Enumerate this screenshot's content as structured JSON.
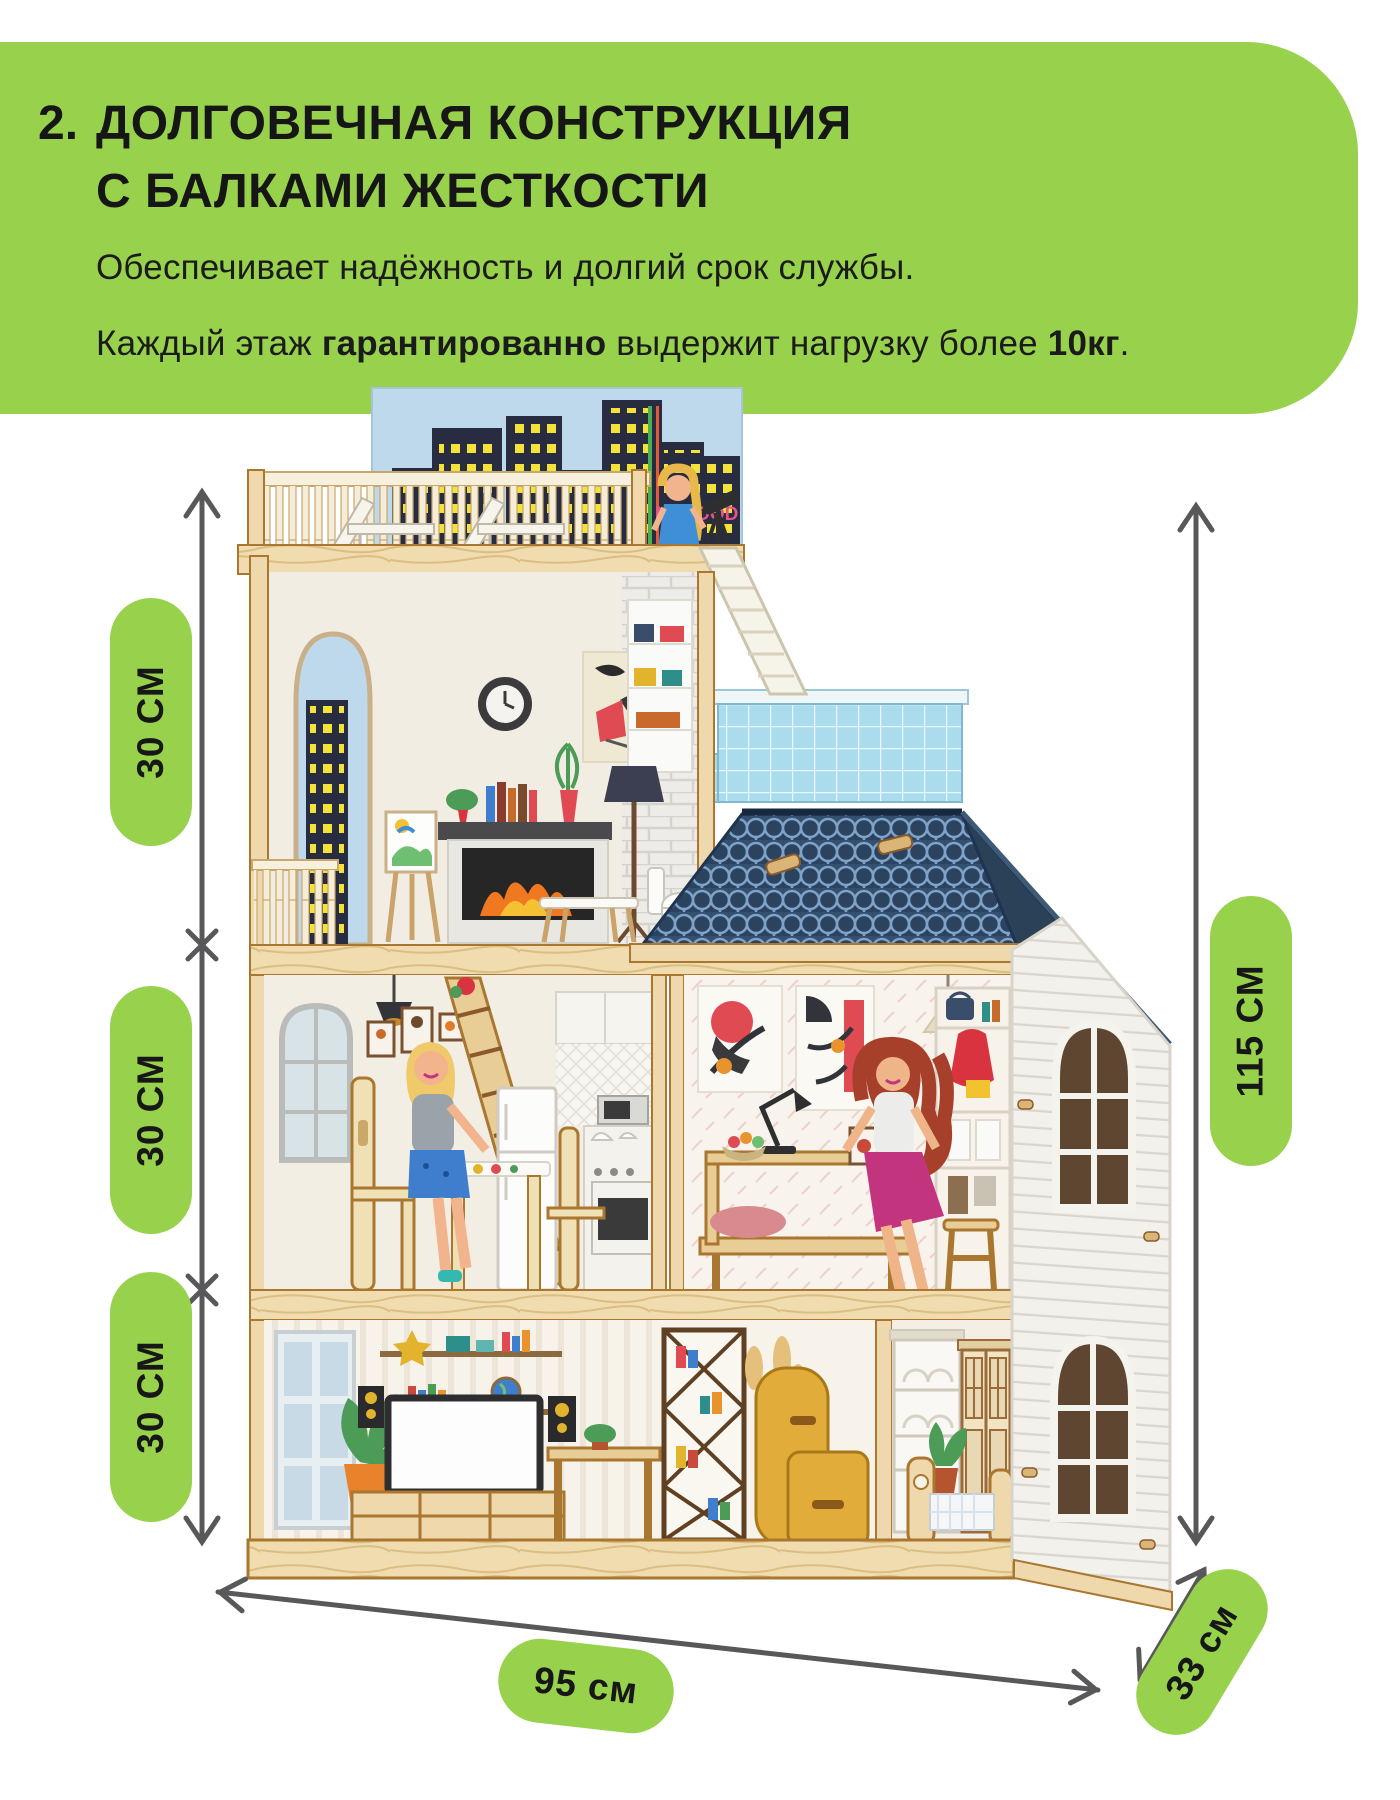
{
  "header": {
    "number": "2.",
    "title_line1": "ДОЛГОВЕЧНАЯ КОНСТРУКЦИЯ",
    "title_line2": "С БАЛКАМИ ЖЕСТКОСТИ",
    "body_line1": "Обеспечивает надёжность и долгий срок службы.",
    "body_line2": {
      "prefix": "Каждый этаж ",
      "bold1": "гарантированно",
      "middle": " выдержит нагрузку более ",
      "bold2": "10кг",
      "suffix": "."
    }
  },
  "dimensions": {
    "floor_heights": [
      "30 СМ",
      "30 СМ",
      "30 СМ"
    ],
    "total_height": "115 СМ",
    "width": "95 см",
    "depth": "33 см"
  },
  "product": {
    "brand_logo": "M·WOOD"
  },
  "colors": {
    "accent_green": "#98D14C",
    "text_dark": "#1B1B1B",
    "arrow_gray": "#58585A",
    "roof_blue": "#33506E",
    "pool_blue": "#ABDCEE",
    "skyline_navy": "#272C40",
    "window_yellow": "#F2E23A",
    "brand_pink": "#E8538C",
    "wood_light": "#EFD9AC"
  }
}
